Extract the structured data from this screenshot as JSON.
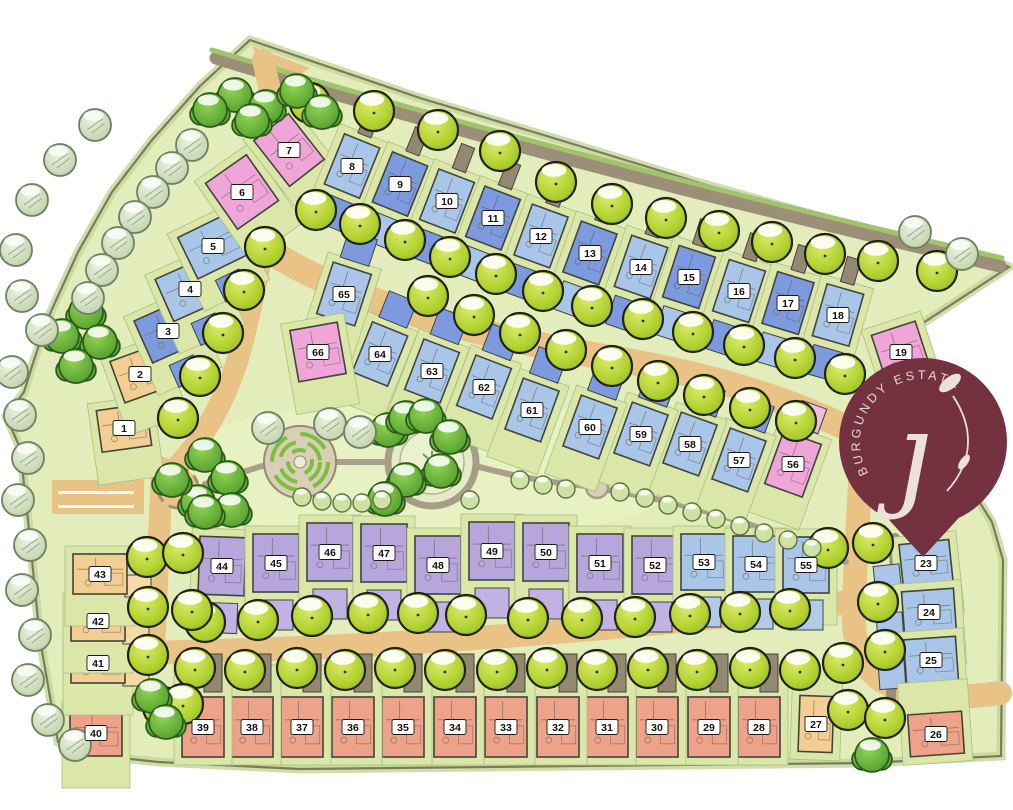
{
  "title": "Burgundy Estate site development plan",
  "logo": {
    "arc_text": "BURGUNDY ESTATE",
    "monogram": "ȷ",
    "pin_color": "#74313f",
    "text_color": "#e8d6d1"
  },
  "palette": {
    "grass": "#e3edbb",
    "lot": "#dbe7a9",
    "road_tan": "#e9c286",
    "road_grey": "#9d8e78",
    "path_grey": "#a99f8a",
    "hedge": "#9fc46c",
    "building_stroke": "#40443b",
    "boundary_stroke": "#7d7a5c"
  },
  "plot_colors": {
    "L": "#a9c6e8",
    "M": "#7e9ade",
    "P": "#f0a5d8",
    "U": "#b7a6dc",
    "S": "#efa28a",
    "T": "#f3cd92"
  },
  "pad_specs": {
    "greyUpSmall": {
      "ox": 0,
      "oy": -46,
      "w": 14,
      "h": 26,
      "c": "#958871"
    },
    "greyUp": {
      "ox": 10,
      "oy": -54,
      "w": 18,
      "h": 38,
      "c": "#958871"
    },
    "padMedDown": {
      "ox": 0,
      "oy": 50,
      "w": 30,
      "h": 30,
      "c": "#7e9ade"
    },
    "padLightDown": {
      "ox": 0,
      "oy": 50,
      "w": 30,
      "h": 30,
      "c": "#a9c6e8"
    },
    "medUp": {
      "ox": 0,
      "oy": -48,
      "w": 30,
      "h": 28,
      "c": "#7e9ade"
    },
    "pinkUp": {
      "ox": 0,
      "oy": -50,
      "w": 26,
      "h": 26,
      "c": "#f4b9e3"
    },
    "purpleDown": {
      "ox": 0,
      "oy": 52,
      "w": 34,
      "h": 30,
      "c": "#c2b2e4"
    },
    "blueDown": {
      "ox": 0,
      "oy": 50,
      "w": 34,
      "h": 30,
      "c": "#b2cbe9"
    },
    "medFront": {
      "ox": 0,
      "oy": 44,
      "w": 26,
      "h": 24,
      "c": "#7e9ade"
    },
    "blueLeft": {
      "ox": -40,
      "oy": 12,
      "w": 26,
      "h": 28,
      "c": "#a9c6e8"
    },
    "tanRight": {
      "ox": 38,
      "oy": 12,
      "w": 26,
      "h": 22,
      "c": "#f6d9a8"
    }
  },
  "plots_schema": [
    "number",
    "cx",
    "cy",
    "w",
    "h",
    "angle",
    "color_key",
    "pads",
    "front"
  ],
  "plots": [
    [
      "1",
      124,
      428,
      50,
      42,
      -8,
      "T",
      [],
      1
    ],
    [
      "2",
      140,
      374,
      48,
      44,
      -20,
      "T",
      [],
      1
    ],
    [
      "3",
      168,
      331,
      54,
      46,
      -24,
      "M",
      [
        "medFront"
      ],
      1
    ],
    [
      "4",
      190,
      289,
      56,
      46,
      -24,
      "L",
      [
        "medFront"
      ],
      1
    ],
    [
      "5",
      213,
      246,
      56,
      46,
      -26,
      "L",
      [
        "medFront"
      ],
      1
    ],
    [
      "6",
      242,
      192,
      50,
      56,
      -35,
      "P",
      [],
      1
    ],
    [
      "7",
      289,
      150,
      44,
      58,
      -38,
      "P",
      [],
      1
    ],
    [
      "8",
      352,
      166,
      38,
      54,
      22,
      "L",
      [
        "greyUpSmall",
        "padMedDown"
      ],
      1
    ],
    [
      "9",
      400,
      184,
      38,
      54,
      22,
      "M",
      [
        "greyUpSmall",
        "padLightDown"
      ],
      1
    ],
    [
      "10",
      447,
      201,
      38,
      54,
      21,
      "L",
      [
        "greyUpSmall",
        "padMedDown"
      ],
      1
    ],
    [
      "11",
      493,
      218,
      38,
      54,
      21,
      "M",
      [
        "greyUpSmall",
        "padLightDown"
      ],
      1
    ],
    [
      "12",
      541,
      236,
      38,
      54,
      20,
      "L",
      [
        "greyUpSmall",
        "padMedDown"
      ],
      1
    ],
    [
      "13",
      590,
      253,
      38,
      54,
      20,
      "M",
      [
        "greyUpSmall",
        "padLightDown"
      ],
      1
    ],
    [
      "14",
      641,
      267,
      38,
      54,
      19,
      "L",
      [
        "greyUpSmall",
        "padMedDown"
      ],
      1
    ],
    [
      "15",
      689,
      277,
      38,
      54,
      18,
      "M",
      [
        "greyUpSmall",
        "padLightDown"
      ],
      1
    ],
    [
      "16",
      739,
      291,
      38,
      54,
      18,
      "L",
      [
        "greyUpSmall",
        "padMedDown"
      ],
      1
    ],
    [
      "17",
      788,
      303,
      38,
      54,
      17,
      "M",
      [
        "greyUpSmall",
        "padLightDown"
      ],
      1
    ],
    [
      "18",
      838,
      315,
      38,
      54,
      16,
      "L",
      [
        "greyUpSmall",
        "padMedDown"
      ],
      1
    ],
    [
      "19",
      901,
      352,
      46,
      50,
      -18,
      "P",
      [],
      1
    ],
    [
      "23",
      926,
      563,
      50,
      42,
      -6,
      "L",
      [
        "blueLeft"
      ],
      1
    ],
    [
      "24",
      929,
      612,
      52,
      44,
      -4,
      "L",
      [
        "blueLeft"
      ],
      1
    ],
    [
      "25",
      931,
      660,
      52,
      44,
      -4,
      "L",
      [
        "blueLeft"
      ],
      1
    ],
    [
      "26",
      936,
      734,
      54,
      42,
      -4,
      "S",
      [],
      -1
    ],
    [
      "27",
      816,
      724,
      34,
      56,
      2,
      "T",
      [],
      -1
    ],
    [
      "28",
      759,
      727,
      42,
      60,
      0,
      "S",
      [
        "greyUp"
      ],
      -1
    ],
    [
      "29",
      709,
      727,
      42,
      60,
      0,
      "S",
      [
        "greyUp"
      ],
      -1
    ],
    [
      "30",
      657,
      727,
      42,
      60,
      0,
      "S",
      [
        "greyUp"
      ],
      -1
    ],
    [
      "31",
      607,
      727,
      42,
      60,
      0,
      "S",
      [
        "greyUp"
      ],
      -1
    ],
    [
      "32",
      558,
      727,
      42,
      60,
      0,
      "S",
      [
        "greyUp"
      ],
      -1
    ],
    [
      "33",
      506,
      727,
      42,
      60,
      0,
      "S",
      [
        "greyUp"
      ],
      -1
    ],
    [
      "34",
      455,
      727,
      42,
      60,
      0,
      "S",
      [
        "greyUp"
      ],
      -1
    ],
    [
      "35",
      403,
      727,
      42,
      60,
      0,
      "S",
      [
        "greyUp"
      ],
      -1
    ],
    [
      "36",
      353,
      727,
      42,
      60,
      0,
      "S",
      [
        "greyUp"
      ],
      -1
    ],
    [
      "37",
      302,
      727,
      42,
      60,
      0,
      "S",
      [
        "greyUp"
      ],
      -1
    ],
    [
      "38",
      252,
      727,
      42,
      60,
      0,
      "S",
      [
        "greyUp"
      ],
      -1
    ],
    [
      "39",
      203,
      727,
      42,
      60,
      0,
      "S",
      [
        "greyUp"
      ],
      -1
    ],
    [
      "40",
      96,
      733,
      52,
      46,
      0,
      "S",
      [],
      1
    ],
    [
      "41",
      98,
      663,
      54,
      40,
      0,
      "T",
      [
        "tanRight"
      ],
      1
    ],
    [
      "42",
      98,
      621,
      54,
      40,
      0,
      "T",
      [
        "tanRight"
      ],
      1
    ],
    [
      "43",
      100,
      574,
      54,
      40,
      0,
      "T",
      [
        "tanRight"
      ],
      1
    ],
    [
      "44",
      222,
      566,
      46,
      58,
      2,
      "U",
      [
        "purpleDown"
      ],
      1
    ],
    [
      "45",
      276,
      563,
      46,
      58,
      0,
      "U",
      [
        "purpleDown"
      ],
      1
    ],
    [
      "46",
      330,
      552,
      46,
      58,
      0,
      "U",
      [
        "purpleDown"
      ],
      1
    ],
    [
      "47",
      384,
      553,
      46,
      58,
      0,
      "U",
      [
        "purpleDown"
      ],
      1
    ],
    [
      "48",
      438,
      565,
      46,
      58,
      0,
      "U",
      [
        "purpleDown"
      ],
      1
    ],
    [
      "49",
      492,
      551,
      46,
      58,
      0,
      "U",
      [
        "purpleDown"
      ],
      1
    ],
    [
      "50",
      546,
      552,
      46,
      58,
      0,
      "U",
      [
        "purpleDown"
      ],
      1
    ],
    [
      "51",
      600,
      563,
      46,
      58,
      0,
      "U",
      [
        "purpleDown"
      ],
      1
    ],
    [
      "52",
      655,
      565,
      46,
      58,
      0,
      "U",
      [
        "purpleDown"
      ],
      1
    ],
    [
      "53",
      704,
      562,
      46,
      56,
      0,
      "L",
      [
        "blueDown"
      ],
      1
    ],
    [
      "54",
      756,
      564,
      46,
      56,
      0,
      "L",
      [
        "blueDown"
      ],
      1
    ],
    [
      "55",
      806,
      565,
      46,
      56,
      0,
      "L",
      [
        "blueDown"
      ],
      1
    ],
    [
      "56",
      793,
      464,
      40,
      56,
      20,
      "P",
      [
        "pinkUp"
      ],
      1
    ],
    [
      "57",
      739,
      460,
      38,
      54,
      20,
      "L",
      [
        "medUp"
      ],
      1
    ],
    [
      "58",
      690,
      444,
      38,
      54,
      20,
      "L",
      [
        "medUp"
      ],
      1
    ],
    [
      "59",
      641,
      434,
      38,
      54,
      20,
      "L",
      [
        "medUp"
      ],
      1
    ],
    [
      "60",
      590,
      427,
      38,
      54,
      20,
      "L",
      [
        "medUp"
      ],
      1
    ],
    [
      "61",
      532,
      410,
      38,
      54,
      20,
      "L",
      [
        "medUp"
      ],
      1
    ],
    [
      "62",
      484,
      387,
      38,
      54,
      21,
      "L",
      [
        "medUp"
      ],
      1
    ],
    [
      "63",
      432,
      371,
      38,
      54,
      21,
      "L",
      [
        "medUp"
      ],
      1
    ],
    [
      "64",
      380,
      354,
      38,
      54,
      22,
      "L",
      [
        "medUp"
      ],
      1
    ],
    [
      "65",
      344,
      294,
      40,
      54,
      18,
      "L",
      [
        "medUp"
      ],
      1
    ],
    [
      "66",
      318,
      352,
      48,
      52,
      -10,
      "P",
      [],
      1
    ]
  ],
  "boundary": "250,40 420,98 560,140 700,183 860,228 990,258 1009,267 900,338 914,398 992,522 1003,560 1001,756 868,763 300,769 158,762 84,754 58,742 40,640 28,520 20,448 6,416 24,392 34,360 48,318 78,252 112,192 152,140 200,86",
  "entrance_wedge": "252,46 310,68 272,94",
  "roads": [
    {
      "d": "M216,58 C470,137 730,203 1000,266",
      "w": 13,
      "c": "#9d8e78"
    },
    {
      "d": "M212,50 C470,128 730,195 1002,258",
      "w": 5,
      "c": "#9fc46c"
    },
    {
      "d": "M263,60 C272,100 281,128 279,148 C268,228 257,282 245,332 C231,394 204,441 168,476",
      "w": 22,
      "c": "#e9c286"
    },
    {
      "d": "M256,242 C340,302 480,336 610,358 C740,380 806,408 864,436",
      "w": 26,
      "c": "#e9c286"
    },
    {
      "d": "M861,462 C858,520 856,560 854,600 C852,642 860,668 884,682 C912,698 950,700 1000,693",
      "w": 24,
      "c": "#e9c286"
    },
    {
      "d": "M162,468 L154,653",
      "w": 22,
      "c": "#e9c286"
    },
    {
      "d": "M146,653 C420,647 660,626 858,601",
      "w": 24,
      "c": "#e9c286"
    },
    {
      "d": "M895,538 L891,700",
      "w": 10,
      "c": "#9d8e78"
    },
    {
      "d": "M205,484 L262,466",
      "w": 6,
      "c": "#a99f8a"
    },
    {
      "d": "M336,462 L388,462",
      "w": 6,
      "c": "#a99f8a"
    },
    {
      "d": "M476,466 C515,477 557,483 586,486",
      "w": 6,
      "c": "#a99f8a"
    },
    {
      "d": "M608,490 C690,503 770,528 846,562",
      "w": 6,
      "c": "#a99f8a"
    }
  ],
  "parking": {
    "x": 52,
    "y": 480,
    "w": 92,
    "h": 34,
    "lines": [
      [
        58,
        491,
        76
      ],
      [
        58,
        505,
        76
      ]
    ]
  },
  "park": {
    "underlay": {
      "cx": 430,
      "cy": 470,
      "rx": 260,
      "ry": 72
    },
    "spiral": {
      "cx": 300,
      "cy": 462,
      "r": 36
    },
    "plaza": {
      "cx": 432,
      "cy": 462,
      "r": 44
    },
    "node": {
      "cx": 597,
      "cy": 487,
      "r": 11
    },
    "roundabout": {
      "cx": 178,
      "cy": 488,
      "r": 20
    }
  },
  "trees": {
    "street": [
      [
        310,
        103
      ],
      [
        374,
        111
      ],
      [
        438,
        130
      ],
      [
        500,
        151
      ],
      [
        556,
        182
      ],
      [
        612,
        204
      ],
      [
        666,
        218
      ],
      [
        719,
        231
      ],
      [
        772,
        242
      ],
      [
        825,
        254
      ],
      [
        878,
        261
      ],
      [
        937,
        271
      ],
      [
        316,
        210
      ],
      [
        360,
        224
      ],
      [
        405,
        240
      ],
      [
        450,
        257
      ],
      [
        496,
        274
      ],
      [
        543,
        291
      ],
      [
        592,
        306
      ],
      [
        643,
        319
      ],
      [
        693,
        332
      ],
      [
        744,
        345
      ],
      [
        795,
        358
      ],
      [
        845,
        374
      ],
      [
        428,
        296
      ],
      [
        474,
        315
      ],
      [
        520,
        333
      ],
      [
        566,
        350
      ],
      [
        612,
        366
      ],
      [
        658,
        381
      ],
      [
        704,
        395
      ],
      [
        750,
        408
      ],
      [
        796,
        421
      ],
      [
        205,
        622
      ],
      [
        258,
        620
      ],
      [
        312,
        616
      ],
      [
        368,
        613
      ],
      [
        418,
        613
      ],
      [
        466,
        615
      ],
      [
        528,
        618
      ],
      [
        582,
        618
      ],
      [
        635,
        617
      ],
      [
        690,
        614
      ],
      [
        740,
        612
      ],
      [
        790,
        609
      ],
      [
        195,
        668
      ],
      [
        245,
        670
      ],
      [
        297,
        668
      ],
      [
        345,
        670
      ],
      [
        395,
        668
      ],
      [
        445,
        670
      ],
      [
        497,
        670
      ],
      [
        547,
        668
      ],
      [
        597,
        670
      ],
      [
        648,
        668
      ],
      [
        697,
        670
      ],
      [
        750,
        668
      ],
      [
        800,
        670
      ],
      [
        265,
        247
      ],
      [
        244,
        290
      ],
      [
        223,
        333
      ],
      [
        200,
        376
      ],
      [
        178,
        418
      ],
      [
        147,
        557
      ],
      [
        183,
        553
      ],
      [
        148,
        607
      ],
      [
        192,
        610
      ],
      [
        148,
        655
      ],
      [
        163,
        707
      ],
      [
        183,
        704
      ],
      [
        873,
        543
      ],
      [
        878,
        602
      ],
      [
        885,
        650
      ],
      [
        843,
        663
      ],
      [
        848,
        710
      ],
      [
        885,
        718
      ],
      [
        828,
        548
      ]
    ],
    "bush": [
      [
        235,
        95
      ],
      [
        266,
        107
      ],
      [
        297,
        91
      ],
      [
        322,
        112
      ],
      [
        252,
        121
      ],
      [
        210,
        110
      ],
      [
        86,
        312
      ],
      [
        62,
        336
      ],
      [
        100,
        342
      ],
      [
        76,
        366
      ],
      [
        205,
        455
      ],
      [
        228,
        478
      ],
      [
        198,
        502
      ],
      [
        232,
        510
      ],
      [
        172,
        480
      ],
      [
        205,
        512
      ],
      [
        388,
        430
      ],
      [
        406,
        418
      ],
      [
        426,
        416
      ],
      [
        450,
        437
      ],
      [
        441,
        471
      ],
      [
        406,
        480
      ],
      [
        385,
        499
      ],
      [
        152,
        696
      ],
      [
        166,
        722
      ],
      [
        872,
        755
      ]
    ],
    "pale": [
      [
        192,
        145
      ],
      [
        172,
        168
      ],
      [
        153,
        192
      ],
      [
        135,
        217
      ],
      [
        118,
        243
      ],
      [
        102,
        270
      ],
      [
        88,
        298
      ],
      [
        95,
        125
      ],
      [
        60,
        160
      ],
      [
        32,
        200
      ],
      [
        16,
        250
      ],
      [
        22,
        296
      ],
      [
        42,
        330
      ],
      [
        12,
        372
      ],
      [
        20,
        415
      ],
      [
        28,
        458
      ],
      [
        18,
        500
      ],
      [
        30,
        545
      ],
      [
        22,
        590
      ],
      [
        35,
        635
      ],
      [
        28,
        680
      ],
      [
        48,
        720
      ],
      [
        75,
        745
      ],
      [
        915,
        232
      ],
      [
        962,
        254
      ],
      [
        268,
        428
      ],
      [
        330,
        424
      ],
      [
        360,
        432
      ]
    ],
    "shrub": [
      [
        302,
        497
      ],
      [
        322,
        501
      ],
      [
        342,
        503
      ],
      [
        362,
        503
      ],
      [
        382,
        500
      ],
      [
        520,
        480
      ],
      [
        543,
        485
      ],
      [
        566,
        489
      ],
      [
        470,
        500
      ],
      [
        620,
        492
      ],
      [
        645,
        498
      ],
      [
        668,
        505
      ],
      [
        692,
        512
      ],
      [
        716,
        519
      ],
      [
        740,
        526
      ],
      [
        764,
        533
      ],
      [
        788,
        540
      ],
      [
        812,
        548
      ]
    ]
  },
  "pin": {
    "cx": 923,
    "cy": 442,
    "r": 84,
    "tail": "880,510 966,510 923,557",
    "arc_d": "M868.4,473.5 A63,63 0 0 1 959.1,390.4"
  }
}
